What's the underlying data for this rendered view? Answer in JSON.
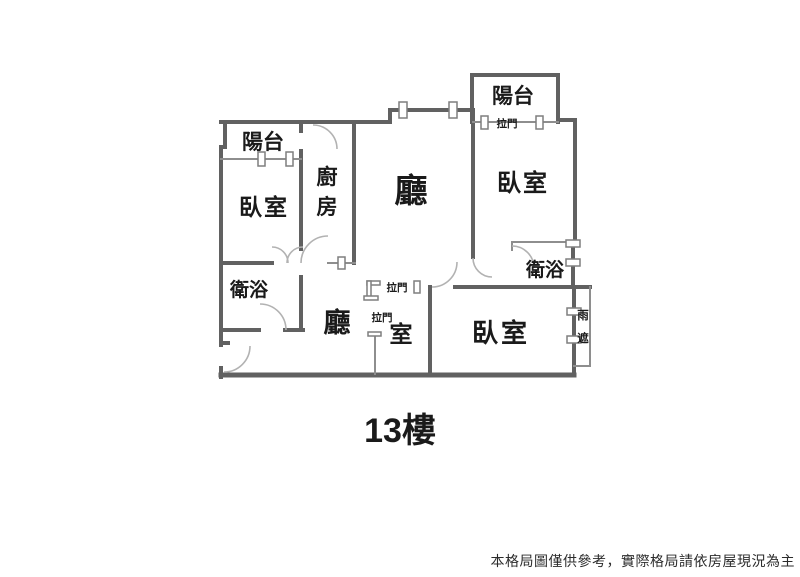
{
  "plan": {
    "floor_label": "13樓",
    "disclaimer": "本格局圖僅供參考，實際格局請依房屋現況為主",
    "rooms": {
      "balcony_left": "陽台",
      "bedroom_left": "臥室",
      "kitchen": "廚房",
      "living_hall": "廳",
      "balcony_right": "陽台",
      "bedroom_right": "臥室",
      "bath_left": "衛浴",
      "bath_right": "衛浴",
      "hall_lower": "廳",
      "multi_room": "室",
      "bedroom_bottom": "臥室",
      "rain_cover": "雨遮"
    },
    "door_labels": {
      "sliding_door_balcony": "拉門",
      "sliding_door_hall": "拉門",
      "sliding_door_room": "拉門"
    },
    "colors": {
      "wall": "#616161",
      "thin_line": "#8e8e8e",
      "arc": "#b2b2b2",
      "symbol_stroke": "#7f7f7f",
      "text": "#1a1a1a",
      "background": "#ffffff"
    }
  }
}
